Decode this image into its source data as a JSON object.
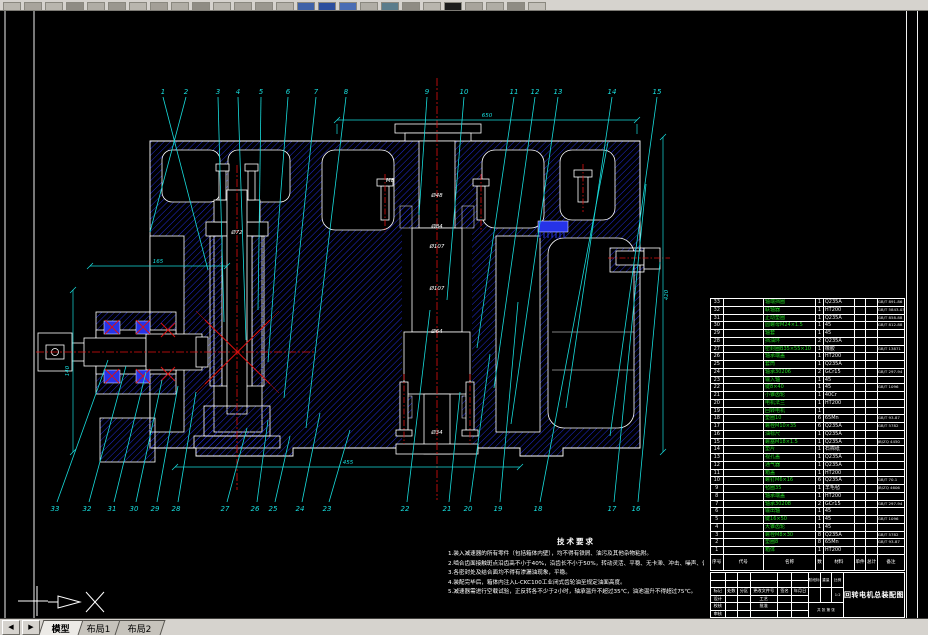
{
  "toolbar": {
    "icons": [
      "#b9b6ae",
      "#a8a49c",
      "#b9b6ae",
      "#8f8c84",
      "#b0ada5",
      "#9a978f",
      "#b9b6ae",
      "#a39f97",
      "#b0ada5",
      "#8f8c84",
      "#b9b6ae",
      "#a8a49c",
      "#9a978f",
      "#b4b1a9",
      "#3f62a8",
      "#2c4f9e",
      "#4a6db4",
      "#b0ada5",
      "#5b7d8c",
      "#8f8c84",
      "#b9b6ae",
      "#1c1c1c",
      "#a8a49c",
      "#b0ada5",
      "#8f8c84",
      "#c2bfb8"
    ]
  },
  "tabs": {
    "nav": [
      "◀",
      "▶"
    ],
    "items": [
      {
        "label": "模型",
        "active": true
      },
      {
        "label": "布局1",
        "active": false
      },
      {
        "label": "布局2",
        "active": false
      }
    ]
  },
  "colors": {
    "hatch_blue": "#2430e8",
    "leader_cyan": "#17dcdc",
    "centerline_red": "#e01010",
    "bom_green": "#21d421",
    "line_white": "#ffffff"
  },
  "drawing": {
    "balloons_top": [
      {
        "n": "1",
        "x": 163,
        "tx": 208,
        "ty": 270
      },
      {
        "n": "2",
        "x": 186,
        "tx": 150,
        "ty": 232
      },
      {
        "n": "3",
        "x": 218,
        "tx": 224,
        "ty": 322
      },
      {
        "n": "4",
        "x": 238,
        "tx": 246,
        "ty": 340
      },
      {
        "n": "5",
        "x": 261,
        "tx": 258,
        "ty": 310
      },
      {
        "n": "6",
        "x": 288,
        "tx": 268,
        "ty": 362
      },
      {
        "n": "7",
        "x": 316,
        "tx": 284,
        "ty": 398
      },
      {
        "n": "8",
        "x": 346,
        "tx": 306,
        "ty": 428
      },
      {
        "n": "9",
        "x": 427,
        "tx": 419,
        "ty": 215
      },
      {
        "n": "10",
        "x": 464,
        "tx": 447,
        "ty": 300
      },
      {
        "n": "11",
        "x": 514,
        "tx": 477,
        "ty": 348
      },
      {
        "n": "12",
        "x": 535,
        "tx": 494,
        "ty": 388
      },
      {
        "n": "13",
        "x": 558,
        "tx": 511,
        "ty": 424
      },
      {
        "n": "14",
        "x": 612,
        "tx": 566,
        "ty": 408
      },
      {
        "n": "15",
        "x": 657,
        "tx": 610,
        "ty": 436
      }
    ],
    "balloons_bottom": [
      {
        "n": "33",
        "x": 55,
        "tx": 108,
        "ty": 360
      },
      {
        "n": "32",
        "x": 87,
        "tx": 126,
        "ty": 366
      },
      {
        "n": "31",
        "x": 112,
        "tx": 146,
        "ty": 372
      },
      {
        "n": "30",
        "x": 134,
        "tx": 162,
        "ty": 380
      },
      {
        "n": "29",
        "x": 155,
        "tx": 178,
        "ty": 386
      },
      {
        "n": "28",
        "x": 176,
        "tx": 196,
        "ty": 392
      },
      {
        "n": "27",
        "x": 225,
        "tx": 247,
        "ty": 428
      },
      {
        "n": "26",
        "x": 255,
        "tx": 268,
        "ty": 420
      },
      {
        "n": "25",
        "x": 273,
        "tx": 290,
        "ty": 436
      },
      {
        "n": "24",
        "x": 300,
        "tx": 320,
        "ty": 413
      },
      {
        "n": "23",
        "x": 327,
        "tx": 350,
        "ty": 430
      },
      {
        "n": "22",
        "x": 405,
        "tx": 430,
        "ty": 310
      },
      {
        "n": "21",
        "x": 447,
        "tx": 460,
        "ty": 392
      },
      {
        "n": "20",
        "x": 468,
        "tx": 490,
        "ty": 354
      },
      {
        "n": "19",
        "x": 498,
        "tx": 518,
        "ty": 302
      },
      {
        "n": "18",
        "x": 538,
        "tx": 608,
        "ty": 142
      },
      {
        "n": "17",
        "x": 612,
        "tx": 646,
        "ty": 184
      },
      {
        "n": "16",
        "x": 636,
        "tx": 660,
        "ty": 262
      }
    ],
    "dim_labels": [
      {
        "t": "650",
        "x": 487,
        "y": 117
      },
      {
        "t": "455",
        "x": 348,
        "y": 464
      },
      {
        "t": "165",
        "x": 158,
        "y": 263
      },
      {
        "t": "420",
        "x": 668,
        "y": 295,
        "rot": true
      },
      {
        "t": "140",
        "x": 69,
        "y": 371,
        "rot": true
      },
      {
        "t": "Ø48",
        "x": 437,
        "y": 197,
        "c": "#ffffff"
      },
      {
        "t": "Ø84",
        "x": 437,
        "y": 228,
        "c": "#ffffff"
      },
      {
        "t": "Ø107",
        "x": 437,
        "y": 248,
        "c": "#ffffff"
      },
      {
        "t": "Ø107",
        "x": 437,
        "y": 290,
        "c": "#ffffff"
      },
      {
        "t": "Ø64",
        "x": 437,
        "y": 333,
        "c": "#ffffff"
      },
      {
        "t": "Ø34",
        "x": 437,
        "y": 434,
        "c": "#ffffff"
      },
      {
        "t": "Ø72",
        "x": 237,
        "y": 234,
        "c": "#ffffff"
      },
      {
        "t": "M8",
        "x": 390,
        "y": 182,
        "c": "#ffffff"
      }
    ]
  },
  "notes": {
    "title": "技术要求",
    "lines": [
      "1.装入减速器的所有零件（包括箱体内壁），均不得有铁屑、油污及其他杂物粘附。",
      "2.啮合齿面接触斑点沿齿高不小于40%，沿齿长不小于50%，转动灵活、平稳、无卡滞、冲击、噪声、偏摆及异常发热现象。",
      "3.各密封处及结合面均不得有渗漏油现象，平稳。",
      "4.装配完毕后，箱体内注入L-CKC100工业闭式齿轮油至规定油面高度。",
      "5.减速器需进行空载试验，正反转各不少于2小时，轴承温升不超过35℃，油池温升不得超过75℃。"
    ]
  },
  "bom": {
    "headers": [
      "序号",
      "代号",
      "名称",
      "数量",
      "材料",
      "单件",
      "总计",
      "备注"
    ],
    "weight_label": "重量(kg)",
    "rows": [
      [
        "33",
        "",
        "轴端挡圈",
        "1",
        "Q235A",
        "",
        "",
        "GB/T 891-86"
      ],
      [
        "32",
        "",
        "联轴器",
        "1",
        "HT200",
        "",
        "",
        "GB/T 5843-03"
      ],
      [
        "31",
        "",
        "止动垫圈",
        "1",
        "Q235A",
        "",
        "",
        "GB/T 858-88"
      ],
      [
        "30",
        "",
        "圆螺母M24×1.5",
        "1",
        "45",
        "",
        "",
        "GB/T 812-88"
      ],
      [
        "29",
        "",
        "轴套",
        "1",
        "45",
        "",
        "",
        ""
      ],
      [
        "28",
        "",
        "挡油环",
        "2",
        "Q235A",
        "",
        "",
        ""
      ],
      [
        "27",
        "",
        "密封圈B35×55×10",
        "1",
        "橡胶",
        "",
        "",
        "GB/T 13871"
      ],
      [
        "26",
        "",
        "轴承端盖",
        "1",
        "HT200",
        "",
        "",
        ""
      ],
      [
        "25",
        "",
        "套筒",
        "1",
        "Q235A",
        "",
        "",
        ""
      ],
      [
        "24",
        "",
        "轴承30206",
        "2",
        "GCr15",
        "",
        "",
        "GB/T 297-94"
      ],
      [
        "23",
        "",
        "输入轴",
        "1",
        "45",
        "",
        "",
        ""
      ],
      [
        "22",
        "",
        "键8×40",
        "1",
        "45",
        "",
        "",
        "GB/T 1096"
      ],
      [
        "21",
        "",
        "小锥齿轮",
        "1",
        "40Cr",
        "",
        "",
        ""
      ],
      [
        "20",
        "",
        "电机法兰",
        "1",
        "HT200",
        "",
        "",
        ""
      ],
      [
        "19",
        "",
        "回转电机",
        "1",
        "",
        "",
        "",
        ""
      ],
      [
        "18",
        "",
        "垫圈10",
        "6",
        "65Mn",
        "",
        "",
        "GB/T 93-87"
      ],
      [
        "17",
        "",
        "螺栓M10×35",
        "6",
        "Q235A",
        "",
        "",
        "GB/T 5782"
      ],
      [
        "16",
        "",
        "油标尺",
        "1",
        "Q235A",
        "",
        "",
        ""
      ],
      [
        "15",
        "",
        "螺塞M18×1.5",
        "1",
        "Q235A",
        "",
        "",
        "JB/ZQ 4450"
      ],
      [
        "14",
        "",
        "垫片",
        "1",
        "石棉纸",
        "",
        "",
        ""
      ],
      [
        "13",
        "",
        "视孔盖",
        "1",
        "Q235A",
        "",
        "",
        ""
      ],
      [
        "12",
        "",
        "通气器",
        "1",
        "Q235A",
        "",
        "",
        ""
      ],
      [
        "11",
        "",
        "箱盖",
        "1",
        "HT200",
        "",
        "",
        ""
      ],
      [
        "10",
        "",
        "螺钉M6×16",
        "6",
        "Q235A",
        "",
        "",
        "GB/T 70.1"
      ],
      [
        "9",
        "",
        "毡圈35",
        "1",
        "羊毛毡",
        "",
        "",
        "JB/ZQ 4606"
      ],
      [
        "8",
        "",
        "轴承端盖",
        "1",
        "HT200",
        "",
        "",
        ""
      ],
      [
        "7",
        "",
        "轴承30208",
        "2",
        "GCr15",
        "",
        "",
        "GB/T 297-94"
      ],
      [
        "6",
        "",
        "输出轴",
        "1",
        "45",
        "",
        "",
        ""
      ],
      [
        "5",
        "",
        "键16×50",
        "1",
        "45",
        "",
        "",
        "GB/T 1096"
      ],
      [
        "4",
        "",
        "大锥齿轮",
        "1",
        "45",
        "",
        "",
        ""
      ],
      [
        "3",
        "",
        "螺栓M8×30",
        "8",
        "Q235A",
        "",
        "",
        "GB/T 5782"
      ],
      [
        "2",
        "",
        "垫圈8",
        "8",
        "65Mn",
        "",
        "",
        "GB/T 93-87"
      ],
      [
        "1",
        "",
        "箱体",
        "1",
        "HT200",
        "",
        "",
        ""
      ]
    ]
  },
  "titleblock": {
    "grid": [
      [
        "",
        "",
        "",
        "",
        "",
        ""
      ],
      [
        "",
        "",
        "",
        "",
        "",
        ""
      ],
      [
        "标记",
        "处数",
        "分区",
        "更改文件号",
        "签名",
        "年月日"
      ],
      [
        "设计",
        "",
        "",
        "工艺",
        "",
        ""
      ],
      [
        "校核",
        "",
        "",
        "批准",
        "",
        ""
      ],
      [
        "审核",
        "",
        "",
        "",
        "",
        ""
      ]
    ],
    "stage": "阶段标记",
    "weight": "重量",
    "scale": "比例",
    "scale_value": "1:2",
    "sheet": "共 张 第 张",
    "title": "回转电机总装配图"
  }
}
